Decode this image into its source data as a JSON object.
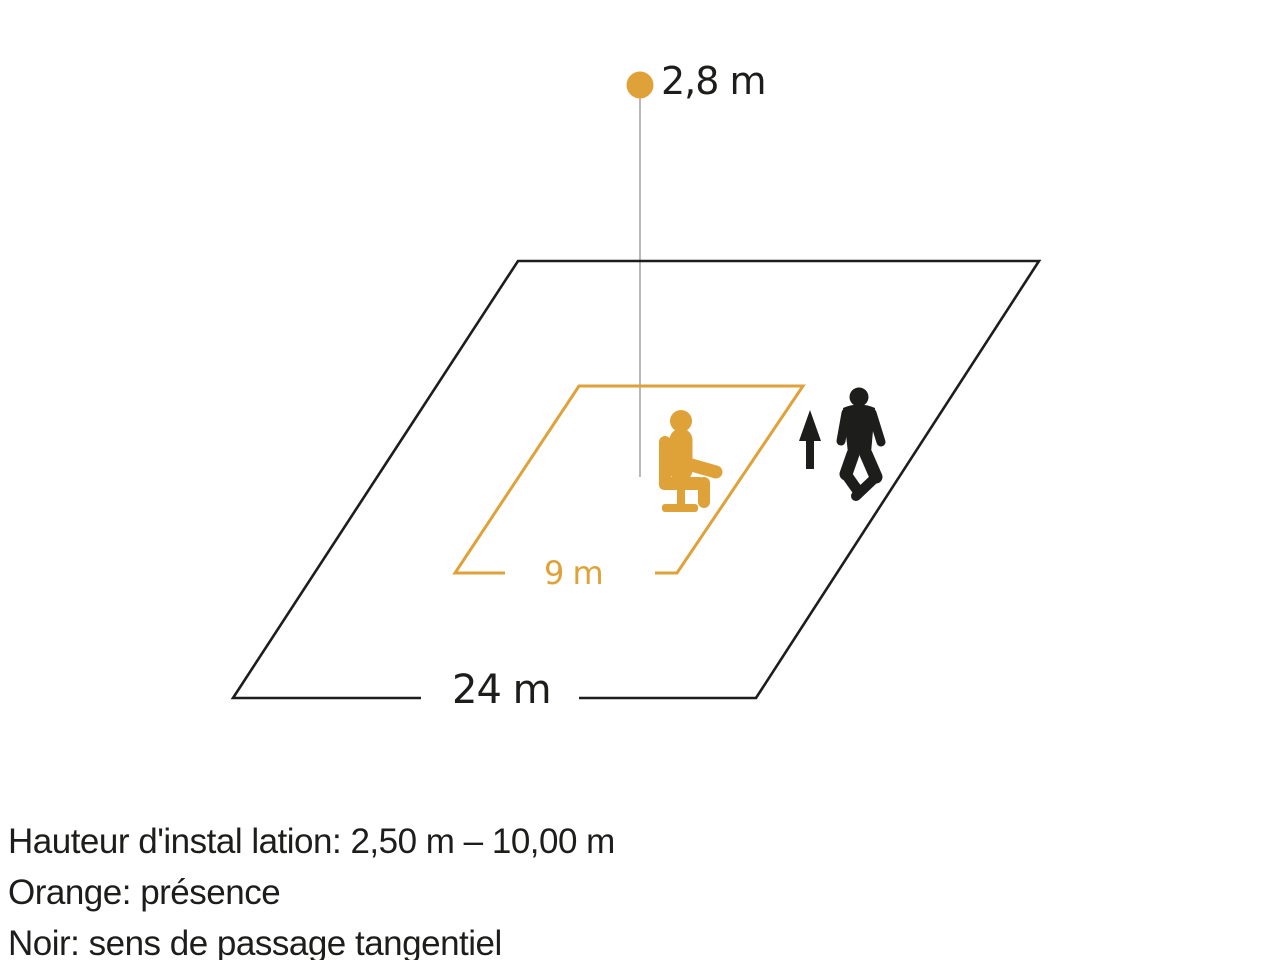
{
  "colors": {
    "orange": "#dfa239",
    "black": "#1d1d1b",
    "height_line_gray": "#8a8a8a"
  },
  "diagram": {
    "sensor_height_label": "2,8 m",
    "outer_area_width_label": "24 m",
    "presence_area_width_label": "9 m",
    "icons": {
      "sensor": "sensor-dot-icon",
      "presence_zone_person": "seated-person-icon",
      "tangential_direction": "up-arrow-icon",
      "tangential_person": "walking-person-icon"
    }
  },
  "legend": {
    "installation_height": "Hauteur d'instal lation: 2,50 m – 10,00 m",
    "orange_meaning": "Orange: présence",
    "black_meaning": "Noir: sens de passage tangentiel"
  }
}
